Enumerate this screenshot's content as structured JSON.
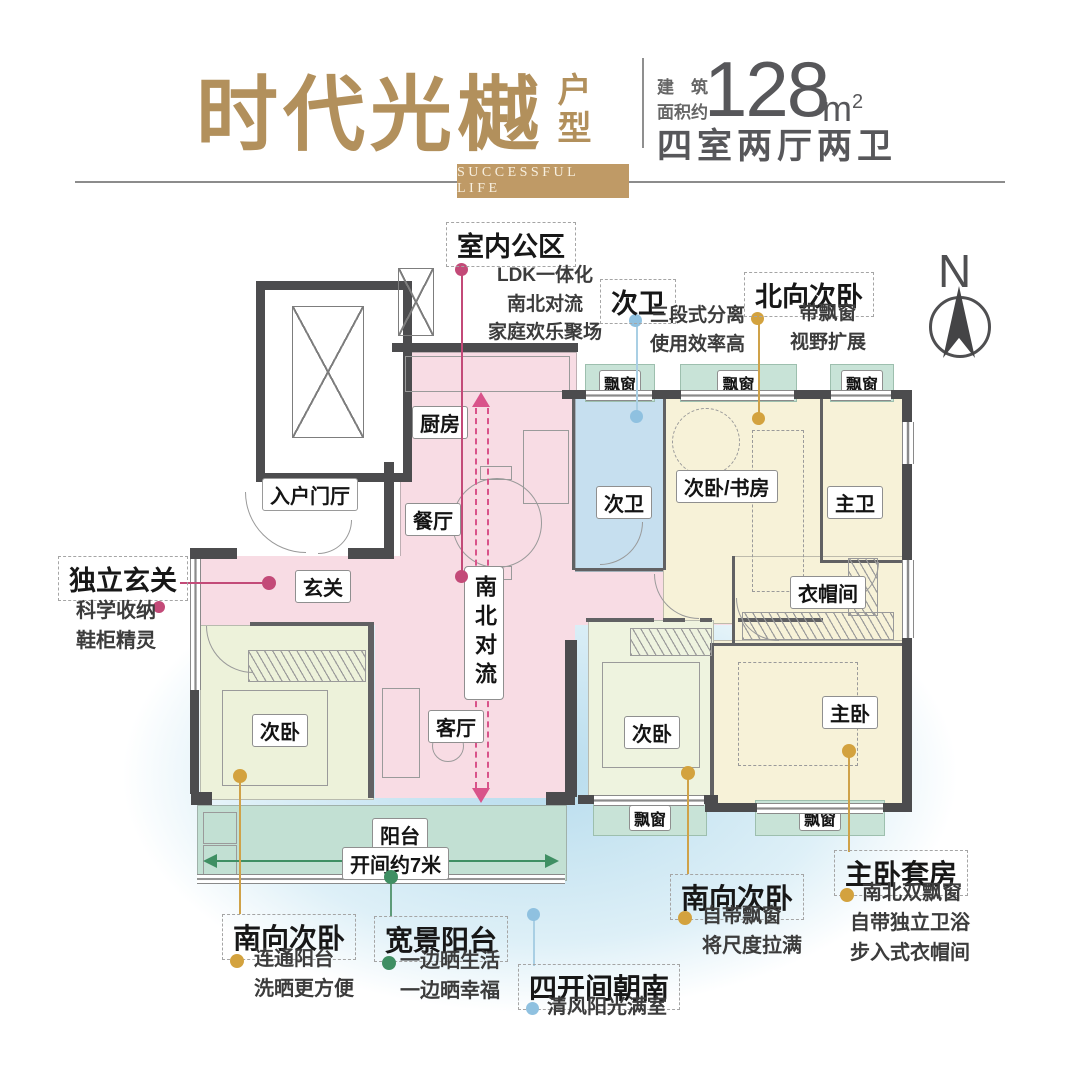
{
  "header": {
    "title": "时代光樾",
    "subtitle": "户型",
    "banner": "SUCCESSFUL LIFE",
    "area_label_line1": "建　筑",
    "area_label_line2": "面积约",
    "area_value": "128",
    "area_unit": "m",
    "area_unit_exp": "2",
    "layout_text": "四室两厅两卫"
  },
  "compass": {
    "north_label": "N"
  },
  "plan": {
    "rooms": {
      "kitchen": "厨房",
      "dining": "餐厅",
      "hallway": "玄关",
      "entry_foyer": "入户门厅",
      "living": "客厅",
      "bedroom_left": "次卧",
      "bedroom_south": "次卧",
      "master_bedroom": "主卧",
      "second_bath": "次卫",
      "study_bedroom": "次卧/书房",
      "master_bath": "主卫",
      "closet": "衣帽间",
      "balcony": "阳台"
    },
    "bay_window_label": "飘窗",
    "flow_label": "南北对流",
    "dimension_label": "开间约7米"
  },
  "callouts": [
    {
      "id": "indoor-public",
      "title": "室内公区",
      "lines": [
        "LDK一体化",
        "南北对流",
        "家庭欢乐聚场"
      ],
      "color": "#c34a78"
    },
    {
      "id": "second-bath",
      "title": "次卫",
      "lines": [
        "三段式分离",
        "使用效率高"
      ],
      "color": "#a9cfe4"
    },
    {
      "id": "north-bedroom",
      "title": "北向次卧",
      "lines": [
        "带飘窗",
        "视野扩展"
      ],
      "color": "#d3a23e"
    },
    {
      "id": "entry-hall",
      "title": "独立玄关",
      "lines": [
        "科学收纳",
        "鞋柜精灵"
      ],
      "color": "#c34a78"
    },
    {
      "id": "south-bedroom-left",
      "title": "南向次卧",
      "lines": [
        "连通阳台",
        "洗晒更方便"
      ],
      "color": "#d3a23e"
    },
    {
      "id": "wide-balcony",
      "title": "宽景阳台",
      "lines": [
        "一边晒生活",
        "一边晒幸福"
      ],
      "color": "#3f8f63"
    },
    {
      "id": "four-bays-south",
      "title": "四开间朝南",
      "lines": [
        "清风阳光满室"
      ],
      "color": "#8fc1e0"
    },
    {
      "id": "south-bedroom-right",
      "title": "南向次卧",
      "lines": [
        "自带飘窗",
        "将尺度拉满"
      ],
      "color": "#d3a23e"
    },
    {
      "id": "master-suite",
      "title": "主卧套房",
      "lines": [
        "南北双飘窗",
        "自带独立卫浴",
        "步入式衣帽间"
      ],
      "color": "#d3a23e"
    }
  ],
  "colors": {
    "brand_gold": "#b2905c",
    "wall": "#4c4c4e",
    "ldk_pink": "#f8dce4",
    "cream_room": "#f7f2d8",
    "green_room": "#edf2da",
    "bath_blue": "#c6dfef",
    "balcony_teal": "#c2e0d3",
    "flow_arrow": "#d9538a"
  }
}
